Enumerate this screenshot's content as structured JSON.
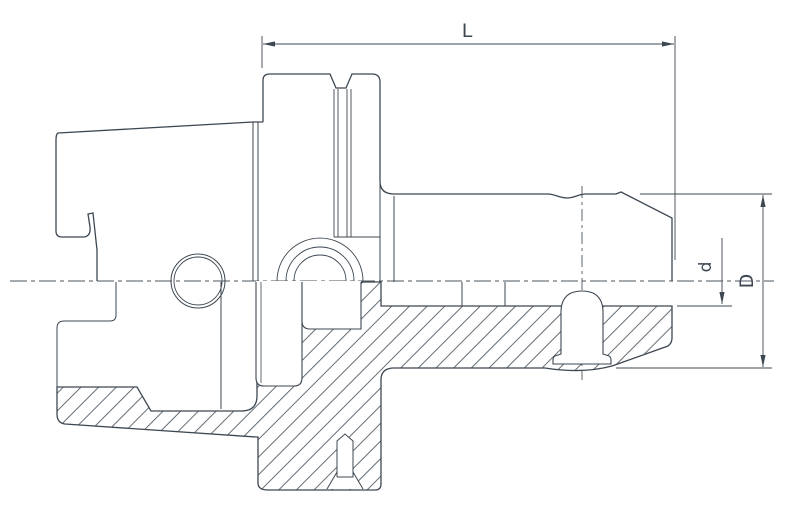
{
  "drawing": {
    "kind": "technical section drawing of a shrink-fit tool holder",
    "colors": {
      "line": "#3d4751",
      "hatch": "#525c66",
      "background": "#ffffff"
    },
    "dimensions": {
      "length": {
        "label": "L"
      },
      "bore_diameter": {
        "label": "d"
      },
      "outer_diameter": {
        "label": "D"
      }
    }
  }
}
